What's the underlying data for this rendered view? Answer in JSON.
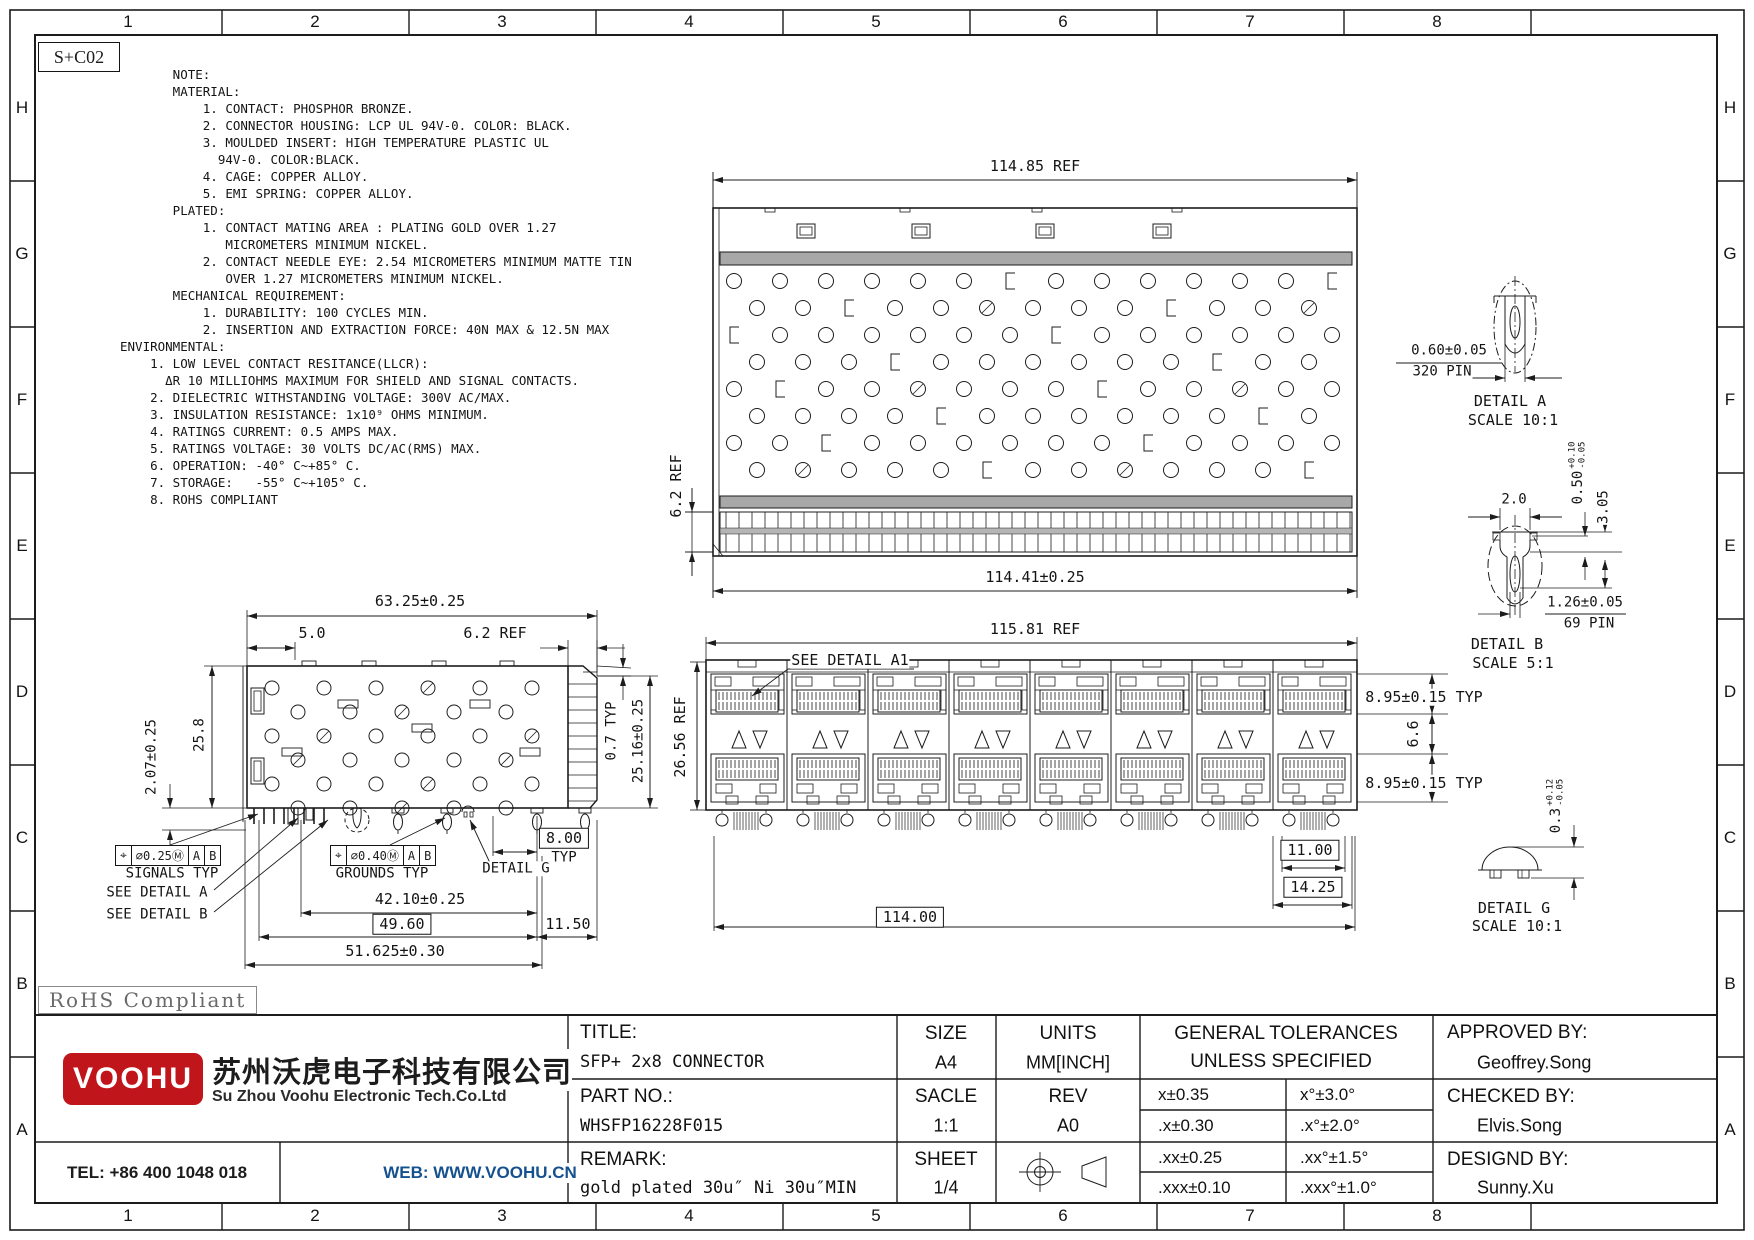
{
  "frame": {
    "doc_code": "S+C02",
    "zone_cols": [
      "1",
      "2",
      "3",
      "4",
      "5",
      "6",
      "7",
      "8"
    ],
    "zone_rows": [
      "H",
      "G",
      "F",
      "E",
      "D",
      "C",
      "B",
      "A"
    ]
  },
  "notes": {
    "lines": [
      "       NOTE:",
      "       MATERIAL:",
      "           1. CONTACT: PHOSPHOR BRONZE.",
      "           2. CONNECTOR HOUSING: LCP UL 94V-0. COLOR: BLACK.",
      "           3. MOULDED INSERT: HIGH TEMPERATURE PLASTIC UL",
      "             94V-0. COLOR:BLACK.",
      "           4. CAGE: COPPER ALLOY.",
      "           5. EMI SPRING: COPPER ALLOY.",
      "       PLATED:",
      "           1. CONTACT MATING AREA : PLATING GOLD OVER 1.27",
      "              MICROMETERS MINIMUM NICKEL.",
      "           2. CONTACT NEEDLE EYE: 2.54 MICROMETERS MINIMUM MATTE TIN",
      "              OVER 1.27 MICROMETERS MINIMUM NICKEL.",
      "       MECHANICAL REQUIREMENT:",
      "           1. DURABILITY: 100 CYCLES MIN.",
      "           2. INSERTION AND EXTRACTION FORCE: 40N MAX & 12.5N MAX",
      "ENVIRONMENTAL:",
      "    1. LOW LEVEL CONTACT RESITANCE(LLCR):",
      "      ΔR 10 MILLIOHMS MAXIMUM FOR SHIELD AND SIGNAL CONTACTS.",
      "    2. DIELECTRIC WITHSTANDING VOLTAGE: 300V AC/MAX.",
      "    3. INSULATION RESISTANCE: 1x10⁹ OHMS MINIMUM.",
      "    4. RATINGS CURRENT: 0.5 AMPS MAX.",
      "    5. RATINGS VOLTAGE: 30 VOLTS DC/AC(RMS) MAX.",
      "    6. OPERATION: -40° C~+85° C.",
      "    7. STORAGE:   -55° C~+105° C.",
      "    8. ROHS COMPLIANT"
    ]
  },
  "top_view": {
    "width_ref": "114.85 REF",
    "comb_ref": "6.2 REF",
    "width_tol": "114.41±0.25"
  },
  "side_view": {
    "total_width": "63.25±0.25",
    "offset": "5.0",
    "comb_ref": "6.2 REF",
    "pin_h": "2.07±0.25",
    "body_h": "25.8",
    "lip": "0.7 TYP",
    "height": "25.16±0.25",
    "signals_fcf": {
      "sym": "⌖",
      "tol": "⌀0.25Ⓜ",
      "d1": "A",
      "d2": "B"
    },
    "signals_label": "SIGNALS TYP",
    "see_a": "SEE DETAIL A",
    "see_b": "SEE DETAIL B",
    "grounds_fcf": {
      "sym": "⌖",
      "tol": "⌀0.40Ⓜ",
      "d1": "A",
      "d2": "B"
    },
    "grounds_label": "GROUNDS TYP",
    "detail_g_ref": "DETAIL G",
    "pitch": "8.00",
    "pitch_typ": "TYP",
    "dim_42": "42.10±0.25",
    "dim_49": "49.60",
    "dim_115": "11.50",
    "dim_51": "51.625±0.30"
  },
  "front_view": {
    "width_ref": "115.81 REF",
    "see_a1": "SEE DETAIL A1",
    "height_ref": "26.56 REF",
    "port_h_top": "8.95±0.15 TYP",
    "gap": "6.6",
    "port_h_bot": "8.95±0.15 TYP",
    "dim_11": "11.00",
    "dim_14": "14.25",
    "dim_114": "114.00"
  },
  "details": {
    "a": {
      "dim": "0.60±0.05",
      "pin": "320 PIN",
      "name": "DETAIL A",
      "scale": "SCALE 10:1"
    },
    "b": {
      "width": "2.0",
      "tol_val": "0.50",
      "tol_p": "+0.10",
      "tol_m": "-0.05",
      "h": "3.05",
      "eye": "1.26±0.05",
      "pin": "69 PIN",
      "name": "DETAIL B",
      "scale": "SCALE 5:1"
    },
    "g": {
      "val": "0.3",
      "tol_p": "+0.12",
      "tol_m": "-0.05",
      "name": "DETAIL G",
      "scale": "SCALE 10:1"
    }
  },
  "rohs": {
    "label": "RoHS Compliant"
  },
  "title_block": {
    "logo": {
      "brand": "VOOHU",
      "company_cn": "苏州沃虎电子科技有限公司",
      "company_en": "Su Zhou Voohu Electronic Tech.Co.Ltd",
      "brand_color": "#c0151b"
    },
    "tel": "TEL: +86 400 1048 018",
    "web": "WEB: WWW.VOOHU.CN",
    "title_label": "TITLE:",
    "title": "SFP+ 2x8 CONNECTOR",
    "size_label": "SIZE",
    "size": "A4",
    "units_label": "UNITS",
    "units": "MM[INCH]",
    "part_label": "PART NO.:",
    "part": "WHSFP16228F015",
    "scale_label": "SACLE",
    "scale": "1:1",
    "rev_label": "REV",
    "rev": "A0",
    "remark_label": "REMARK:",
    "remark": "gold plated 30u″ Ni 30u″MIN",
    "sheet_label": "SHEET",
    "sheet": "1/4",
    "tol_header1": "GENERAL TOLERANCES",
    "tol_header2": "UNLESS SPECIFIED",
    "tolerances": [
      [
        "x±0.35",
        "x°±3.0°"
      ],
      [
        ".x±0.30",
        ".x°±2.0°"
      ],
      [
        ".xx±0.25",
        ".xx°±1.5°"
      ],
      [
        ".xxx±0.10",
        ".xxx°±1.0°"
      ]
    ],
    "approved_label": "APPROVED BY:",
    "approved": "Geoffrey.Song",
    "checked_label": "CHECKED BY:",
    "checked": "Elvis.Song",
    "designed_label": "DESIGND BY:",
    "designed": "Sunny.Xu"
  }
}
